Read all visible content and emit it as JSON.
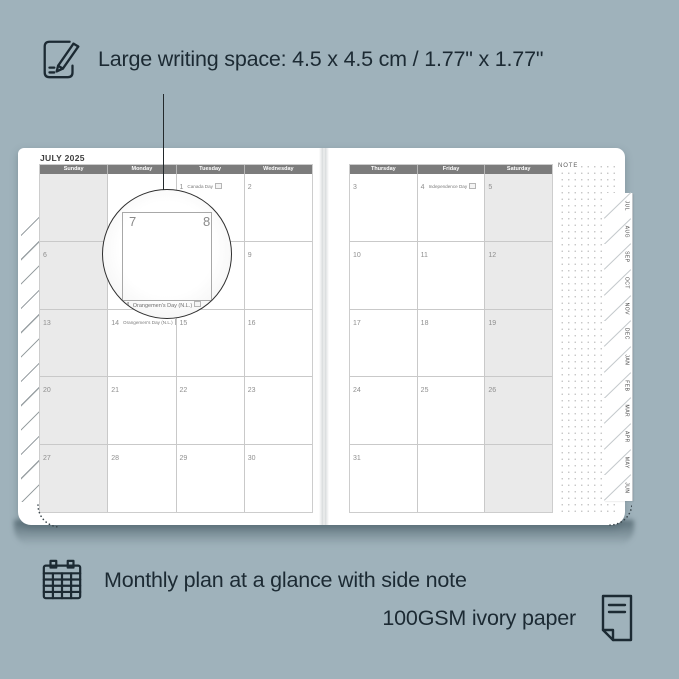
{
  "colors": {
    "background": "#9FB2BB",
    "ink": "#1C2A33",
    "page": "#FFFFFF",
    "header_bar": "#7C7C7C",
    "shaded_column": "#EAEAEA",
    "grid_line": "#C9C9C9"
  },
  "top_callout": {
    "text": "Large writing space: 4.5 x 4.5 cm / 1.77\" x 1.77\""
  },
  "planner": {
    "title": "JULY 2025",
    "note_label": "NOTE",
    "tabs": [
      "JUL",
      "AUG",
      "SEP",
      "OCT",
      "NOV",
      "DEC",
      "JAN",
      "FEB",
      "MAR",
      "APR",
      "MAY",
      "JUN"
    ],
    "left_page": {
      "headers": [
        "Sunday",
        "Monday",
        "Tuesday",
        "Wednesday"
      ],
      "shaded_column": 0,
      "weeks": [
        [
          {
            "day": ""
          },
          {
            "day": ""
          },
          {
            "day": "1",
            "holiday": "Canada Day"
          },
          {
            "day": "2"
          }
        ],
        [
          {
            "day": "6"
          },
          {
            "day": "7"
          },
          {
            "day": "8"
          },
          {
            "day": "9"
          }
        ],
        [
          {
            "day": "13"
          },
          {
            "day": "14",
            "holiday": "Orangemen's Day (N.L.)"
          },
          {
            "day": "15"
          },
          {
            "day": "16"
          }
        ],
        [
          {
            "day": "20"
          },
          {
            "day": "21"
          },
          {
            "day": "22"
          },
          {
            "day": "23"
          }
        ],
        [
          {
            "day": "27"
          },
          {
            "day": "28"
          },
          {
            "day": "29"
          },
          {
            "day": "30"
          }
        ]
      ]
    },
    "right_page": {
      "headers": [
        "Thursday",
        "Friday",
        "Saturday"
      ],
      "shaded_column": 2,
      "weeks": [
        [
          {
            "day": "3"
          },
          {
            "day": "4",
            "holiday": "Independence Day"
          },
          {
            "day": "5"
          }
        ],
        [
          {
            "day": "10"
          },
          {
            "day": "11"
          },
          {
            "day": "12"
          }
        ],
        [
          {
            "day": "17"
          },
          {
            "day": "18"
          },
          {
            "day": "19"
          }
        ],
        [
          {
            "day": "24"
          },
          {
            "day": "25"
          },
          {
            "day": "26"
          }
        ],
        [
          {
            "day": "31"
          },
          {
            "day": ""
          },
          {
            "day": ""
          }
        ]
      ]
    }
  },
  "magnifier": {
    "day_left": "7",
    "day_right": "8",
    "footer_day": "4",
    "footer_text": "Orangemen's Day (N.L.)"
  },
  "bottom_callout": {
    "line1": "Monthly plan at a glance with side note",
    "line2": "100GSM ivory paper"
  }
}
